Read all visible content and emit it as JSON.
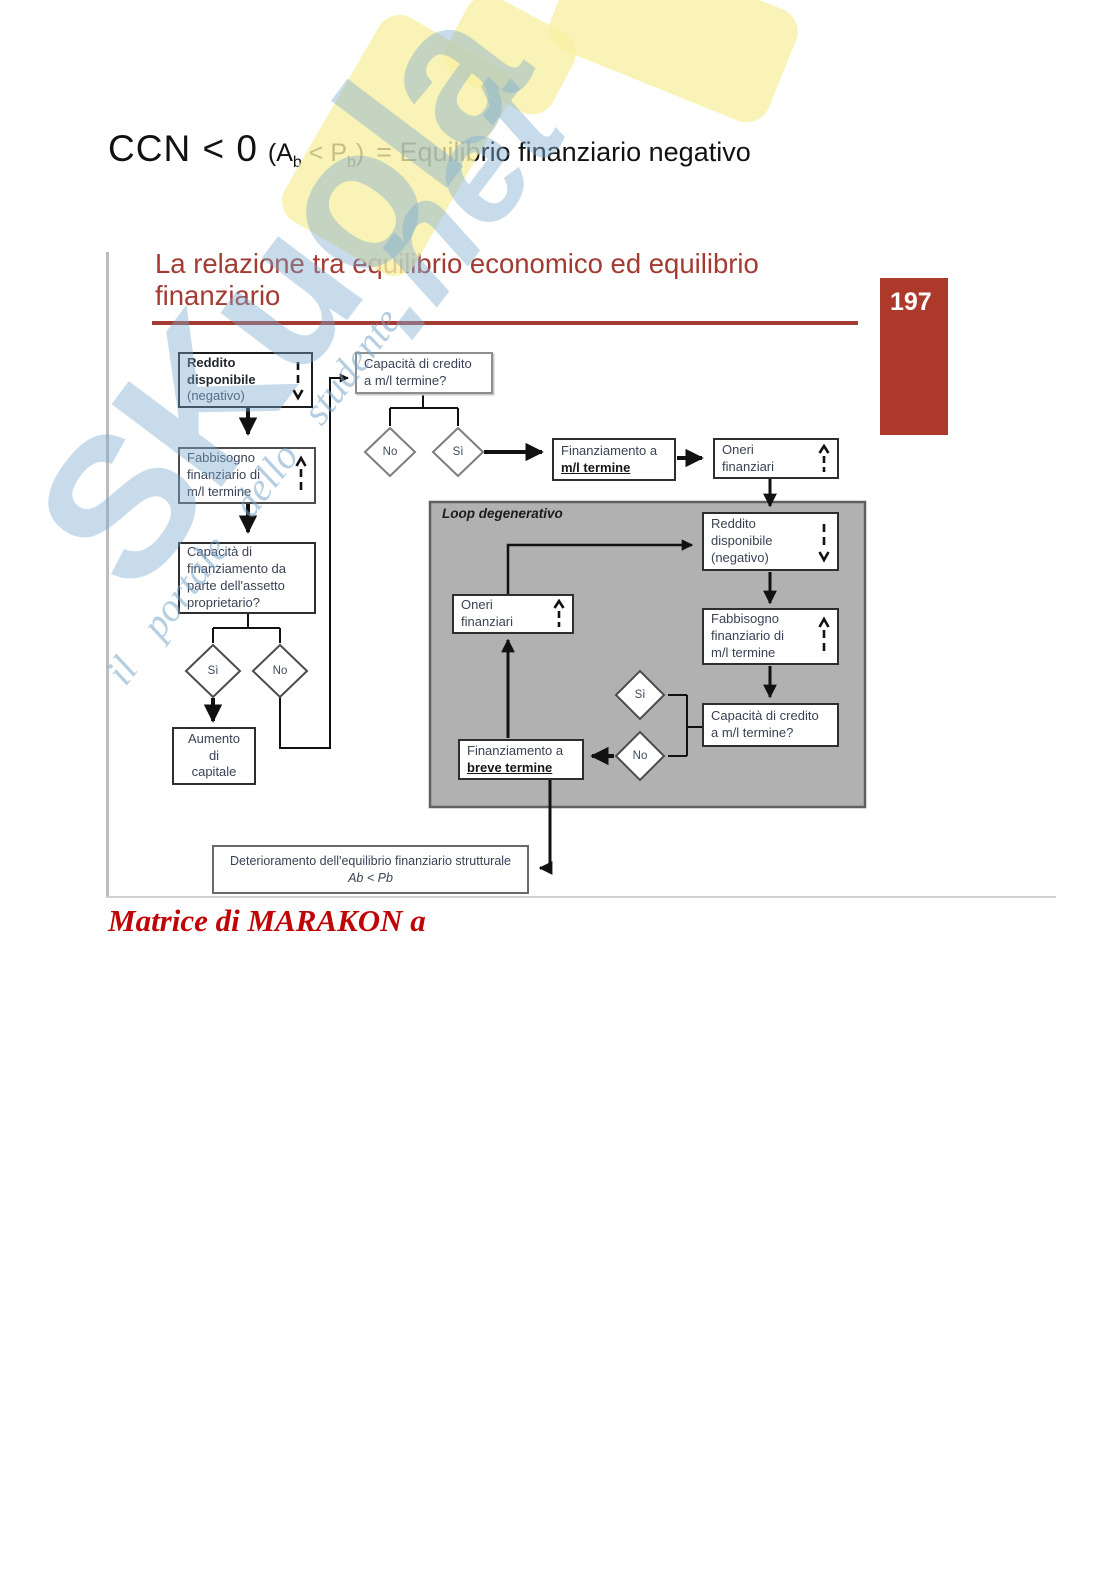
{
  "heading": {
    "ccn": "CCN < 0",
    "open": "(",
    "a": "A",
    "a_sub": "b",
    "lt": " < ",
    "p": "P",
    "p_sub": "b",
    "close": ")",
    "rest": "= Equilibrio finanziario negativo"
  },
  "watermark": {
    "brand": "SKuola",
    "brand_suffix": ".net",
    "tagline": "il portale dello studente"
  },
  "slide": {
    "title_line1": "La relazione tra equilibrio economico ed equilibrio",
    "title_line2": "finanziario",
    "page_number": "197"
  },
  "flow": {
    "loop_label": "Loop degenerativo",
    "reddito": {
      "l1": "Reddito",
      "l2": "disponibile",
      "l3": "(negativo)"
    },
    "cap_credito": {
      "l1": "Capacità di credito",
      "l2": "a m/l termine?"
    },
    "fabbisogno": {
      "l1": "Fabbisogno",
      "l2": "finanziario di",
      "l3": "m/l termine"
    },
    "fin_ml": {
      "l1": "Finanziamento a",
      "l2": "m/l termine"
    },
    "oneri": {
      "l1": "Oneri",
      "l2": "finanziari"
    },
    "cap_fin": {
      "l1": "Capacità di",
      "l2": "finanziamento da",
      "l3": "parte dell'assetto",
      "l4": "proprietario?"
    },
    "aumento": {
      "l1": "Aumento",
      "l2": "di",
      "l3": "capitale"
    },
    "reddito2": {
      "l1": "Reddito",
      "l2": "disponibile",
      "l3": "(negativo)"
    },
    "oneri2": {
      "l1": "Oneri",
      "l2": "finanziari"
    },
    "fabbisogno2": {
      "l1": "Fabbisogno",
      "l2": "finanziario di",
      "l3": "m/l termine"
    },
    "cap_credito2": {
      "l1": "Capacità di credito",
      "l2": "a m/l termine?"
    },
    "fin_breve": {
      "l1": "Finanziamento a",
      "l2": "breve termine"
    },
    "deterioramento": {
      "l1": "Deterioramento dell'equilibrio finanziario strutturale",
      "l2": "Ab < Pb"
    },
    "d_no1": "No",
    "d_si1": "Sì",
    "d_si2": "Sì",
    "d_no2": "No",
    "d_si3": "Sì",
    "d_no3": "No"
  },
  "footer": {
    "caption": "Matrice di MARAKON a"
  }
}
